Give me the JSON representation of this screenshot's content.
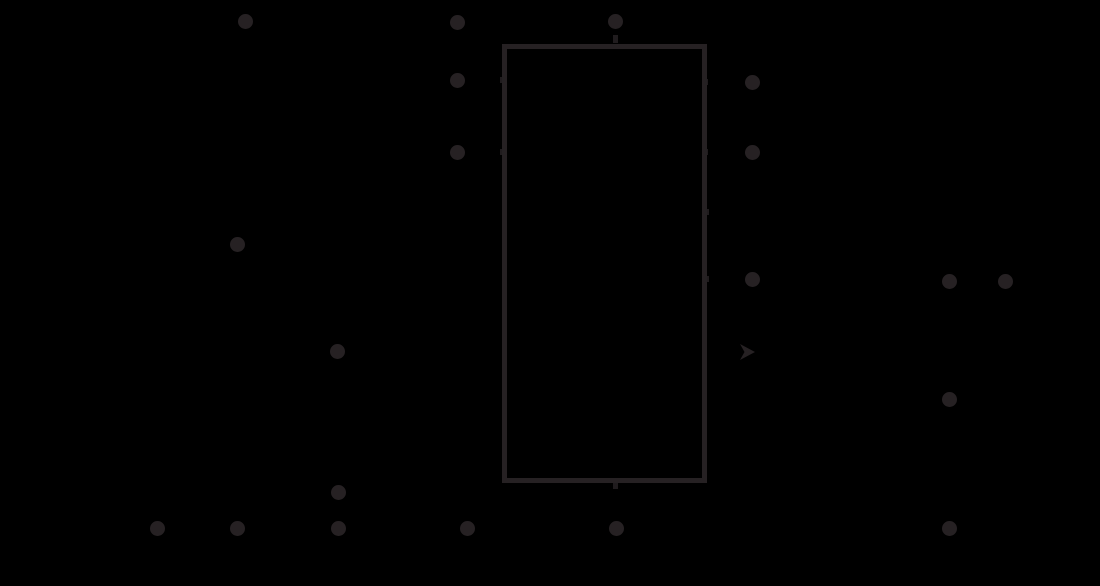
{
  "canvas": {
    "width": 1100,
    "height": 586,
    "background_color": "#000000"
  },
  "diagram": {
    "kind": "schematic-fragment",
    "ink_color": "#262123",
    "component_box": {
      "x": 502,
      "y": 44,
      "width": 205,
      "height": 439,
      "stroke_width": 5
    },
    "dot_diameter": 15,
    "junction_dots": [
      {
        "x": 245,
        "y": 21
      },
      {
        "x": 457,
        "y": 22
      },
      {
        "x": 615,
        "y": 21
      },
      {
        "x": 457,
        "y": 80
      },
      {
        "x": 752,
        "y": 82
      },
      {
        "x": 457,
        "y": 152
      },
      {
        "x": 752,
        "y": 152
      },
      {
        "x": 237,
        "y": 244
      },
      {
        "x": 752,
        "y": 279
      },
      {
        "x": 949,
        "y": 281
      },
      {
        "x": 1005,
        "y": 281
      },
      {
        "x": 337,
        "y": 351
      },
      {
        "x": 949,
        "y": 399
      },
      {
        "x": 338,
        "y": 492
      },
      {
        "x": 157,
        "y": 528
      },
      {
        "x": 237,
        "y": 528
      },
      {
        "x": 338,
        "y": 528
      },
      {
        "x": 467,
        "y": 528
      },
      {
        "x": 616,
        "y": 528
      },
      {
        "x": 949,
        "y": 528
      }
    ],
    "arrowhead": {
      "x": 740,
      "y": 344,
      "width": 15,
      "height": 16,
      "direction": "right"
    },
    "wire_stubs": [
      {
        "x": 613,
        "y": 35,
        "w": 5,
        "h": 8
      },
      {
        "x": 500,
        "y": 77,
        "w": 4,
        "h": 6
      },
      {
        "x": 705,
        "y": 79,
        "w": 3,
        "h": 6
      },
      {
        "x": 500,
        "y": 149,
        "w": 4,
        "h": 6
      },
      {
        "x": 705,
        "y": 149,
        "w": 3,
        "h": 6
      },
      {
        "x": 705,
        "y": 209,
        "w": 4,
        "h": 6
      },
      {
        "x": 705,
        "y": 276,
        "w": 4,
        "h": 6
      },
      {
        "x": 613,
        "y": 482,
        "w": 5,
        "h": 7
      }
    ]
  }
}
